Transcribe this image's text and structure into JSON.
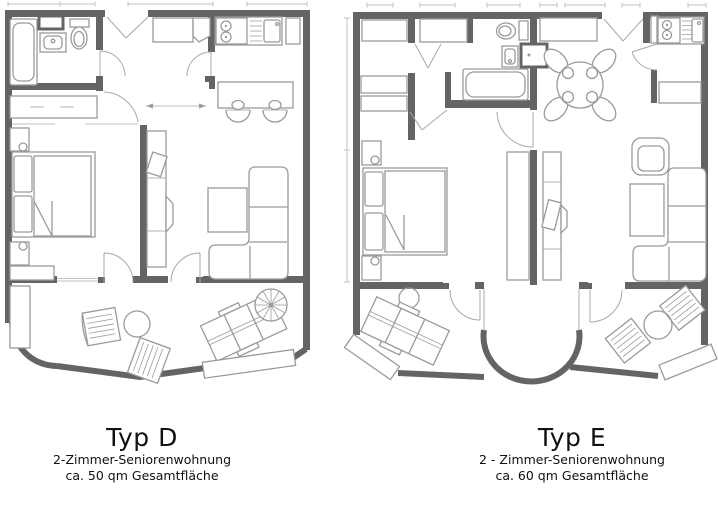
{
  "colors": {
    "background": "#ffffff",
    "wall": "#646464",
    "furniture_line": "#9a9a9a",
    "thin_line": "#c2c2c2",
    "door_line": "#a8a8a8",
    "text": "#111111"
  },
  "plans": [
    {
      "id": "typ-d",
      "title": "Typ D",
      "subtitle": "2-Zimmer-Seniorenwohnung",
      "area_line": "ca. 50 qm Gesamtfläche",
      "features": [
        "bathtub",
        "washbasin",
        "toilet",
        "mirror-cabinet",
        "entry-wardrobe",
        "kitchenette-stove",
        "kitchenette-sink",
        "bar-counter",
        "bar-stools",
        "double-bed",
        "pillows",
        "nightstands",
        "dresser",
        "sideboard",
        "tv-sideboard",
        "coffee-table",
        "corner-sofa",
        "balcony",
        "outdoor-chair",
        "outdoor-table",
        "sun-loungers",
        "parasol",
        "planter"
      ]
    },
    {
      "id": "typ-e",
      "title": "Typ E",
      "subtitle": "2 - Zimmer-Seniorenwohnung",
      "area_line": "ca. 60 qm Gesamtfläche",
      "features": [
        "hall-closets",
        "bathtub",
        "washbasin",
        "toilet",
        "bathroom-door",
        "hall-cabinet",
        "kitchenette-stove",
        "kitchenette-sink",
        "kitchen-sideboard",
        "dining-table",
        "dining-chairs",
        "double-bed",
        "pillows",
        "nightstands",
        "wardrobe",
        "tv-sideboard",
        "armchair",
        "coffee-table",
        "corner-sofa",
        "bay-window",
        "balconies",
        "sun-lounger",
        "outdoor-chairs",
        "outdoor-tables",
        "planters"
      ]
    }
  ]
}
